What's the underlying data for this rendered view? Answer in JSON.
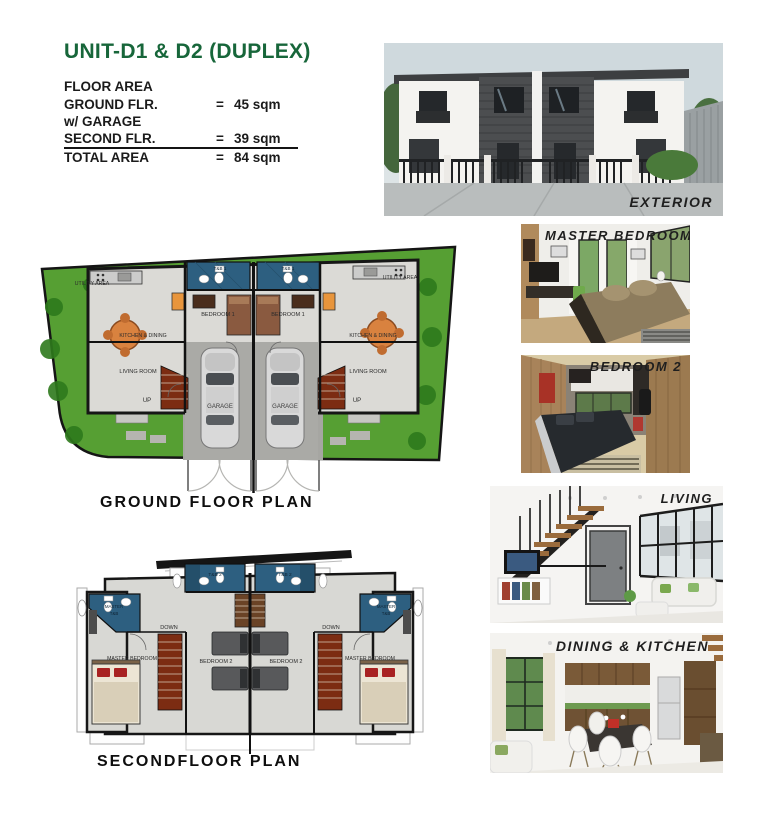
{
  "header": {
    "title": "UNIT-D1 & D2 (DUPLEX)"
  },
  "floor_area": {
    "heading": "FLOOR AREA",
    "rows": [
      {
        "label": "GROUND FLR.",
        "eq": "=",
        "amount": "45 sqm"
      },
      {
        "label": "w/ GARAGE",
        "eq": "",
        "amount": ""
      },
      {
        "label": "SECOND FLR.",
        "eq": "=",
        "amount": "39 sqm"
      },
      {
        "label": "TOTAL AREA",
        "eq": "=",
        "amount": "84 sqm"
      }
    ]
  },
  "captions": {
    "ground_floor": "GROUND FLOOR PLAN",
    "second_floor": "SECONDFLOOR PLAN"
  },
  "photo_labels": {
    "exterior": "EXTERIOR",
    "master_bedroom": "MASTER BEDROOM",
    "bedroom_2": "BEDROOM 2",
    "living": "LIVING",
    "dining_kitchen": "DINING & KITCHEN"
  },
  "ground_floor_rooms": {
    "utility": "UTILITY AREA",
    "kitchen_dining": "KITCHEN & DINING",
    "living_room": "LIVING ROOM",
    "up": "UP",
    "garage": "GARAGE",
    "bedroom_1": "BEDROOM 1",
    "tb_1": "T&B 1"
  },
  "second_floor_rooms": {
    "tb_2": "T&B 2",
    "master_tb_line1": "MASTER",
    "master_tb_line2": "T&B",
    "down": "DOWN",
    "master_bedroom": "MASTER BEDROOM",
    "bedroom_2": "BEDROOM 2"
  },
  "colors": {
    "accent_green": "#17663A",
    "plan_blue": "#2D5F80",
    "lawn_green": "#569F33",
    "stair_brown": "#7C2C12",
    "wall_black": "#151515"
  }
}
